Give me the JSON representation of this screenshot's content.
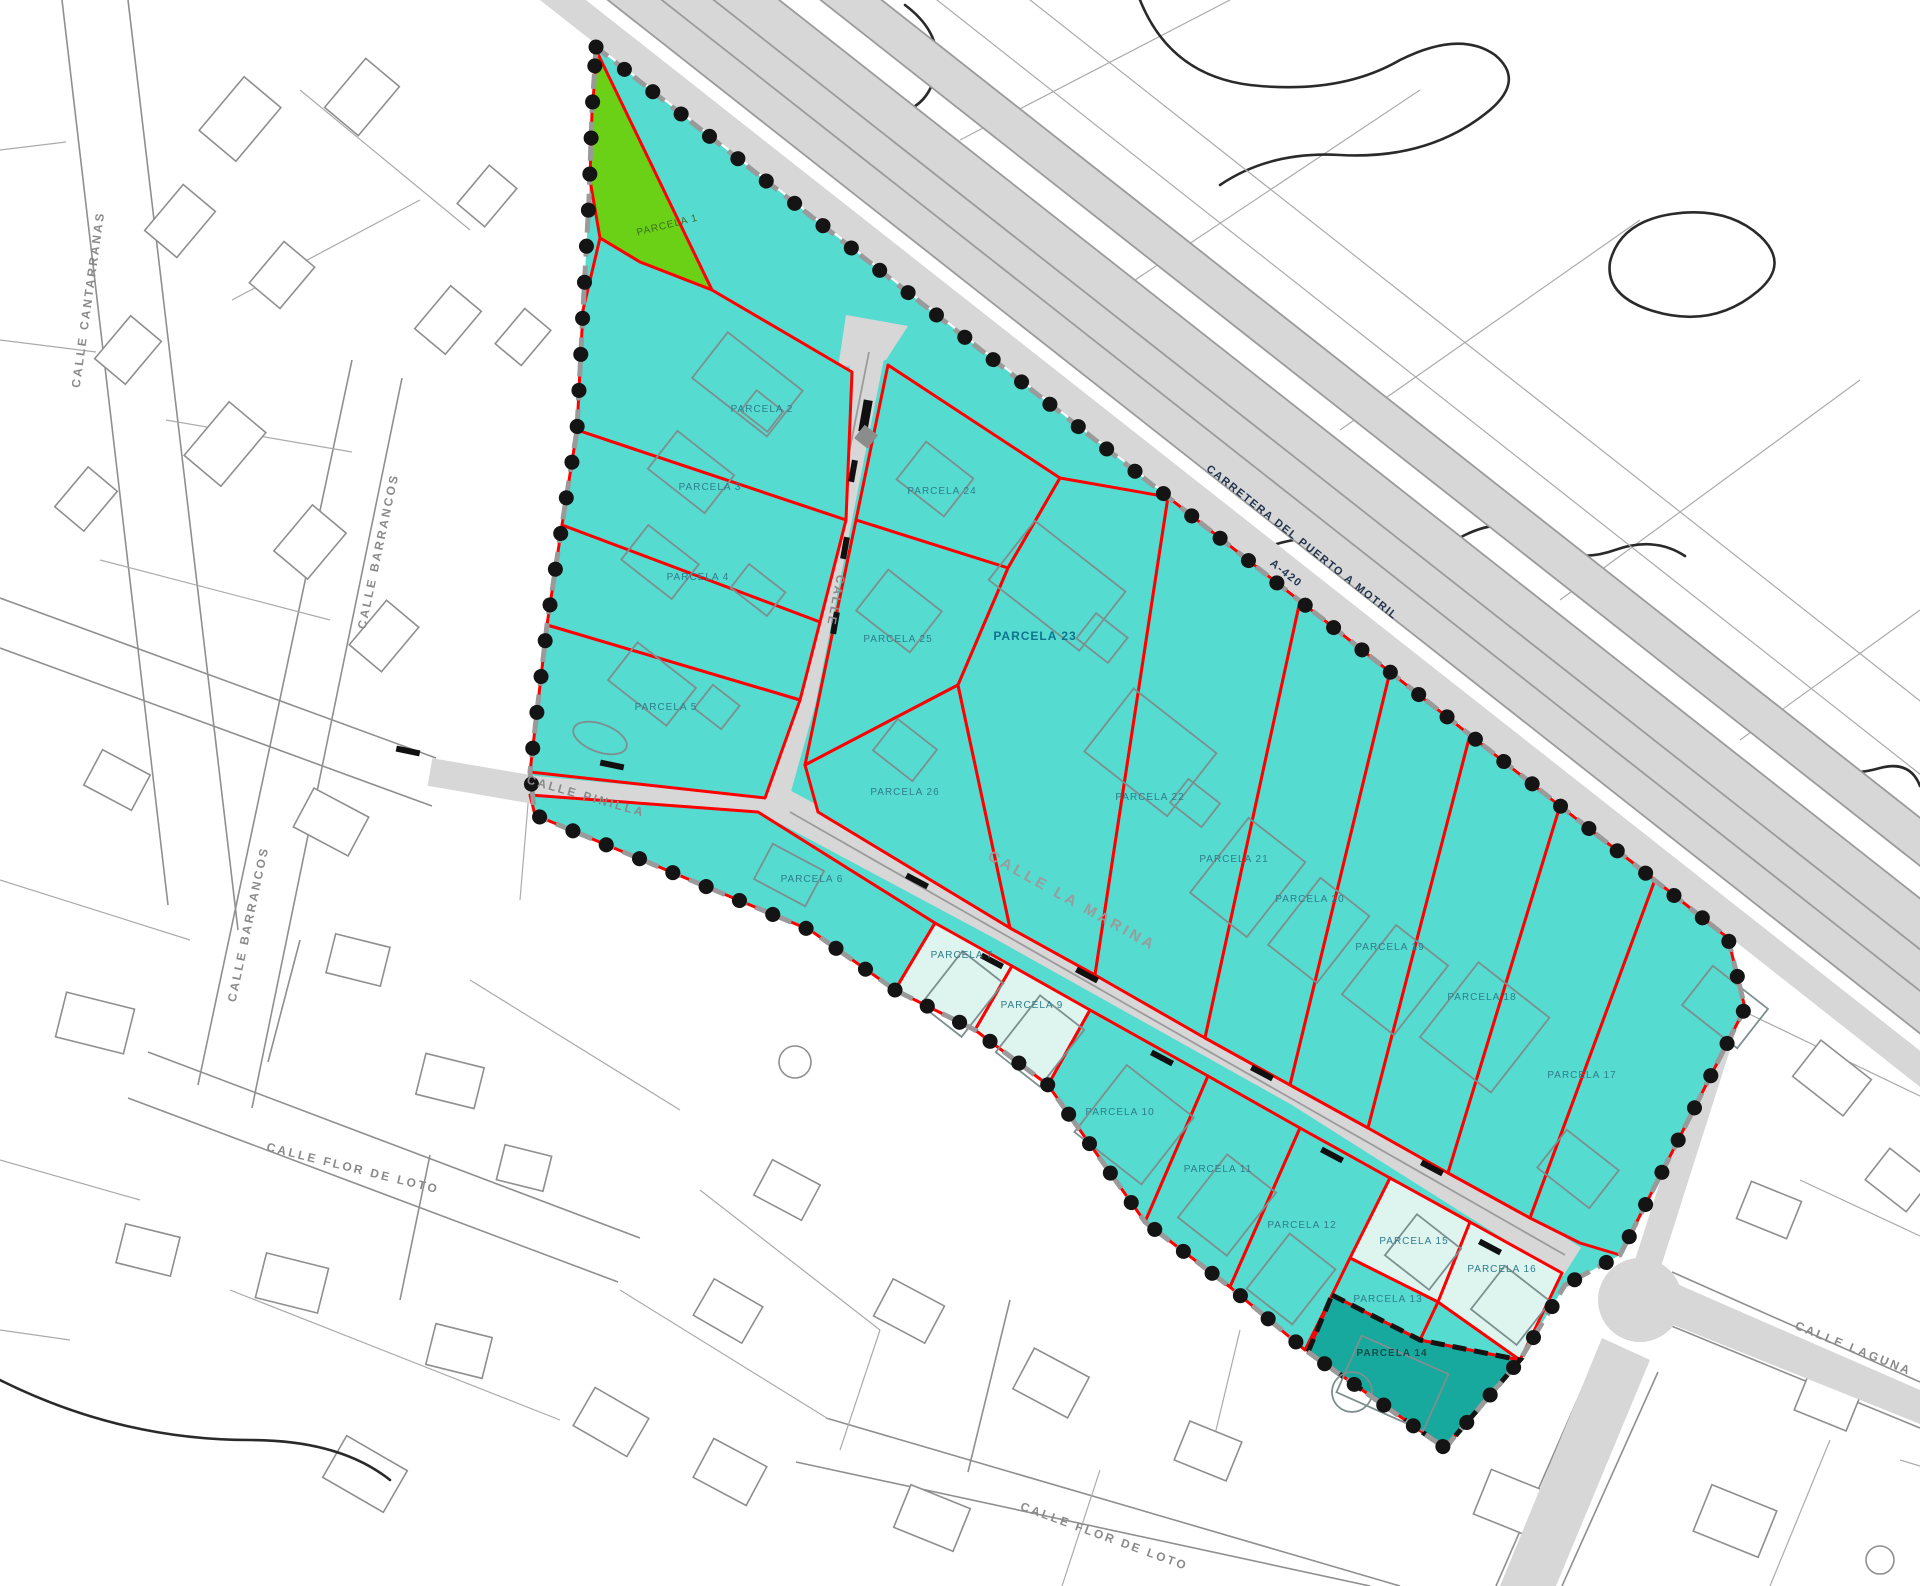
{
  "map": {
    "title": "Plano parcelario de urbanización",
    "highway_label": {
      "line1": "CARRETERA DEL PUERTO A MOTRIL",
      "line2": "A-420"
    },
    "streets": [
      {
        "id": "calle-cantarranas",
        "text": "CALLE CANTARRANAS"
      },
      {
        "id": "calle-barrancos-upper",
        "text": "CALLE BARRANCOS"
      },
      {
        "id": "calle-barrancos-lower",
        "text": "CALLE BARRANCOS"
      },
      {
        "id": "calle-flor-de-loto-west",
        "text": "CALLE FLOR DE LOTO"
      },
      {
        "id": "calle-flor-de-loto-south",
        "text": "CALLE FLOR DE LOTO"
      },
      {
        "id": "calle-laguna",
        "text": "CALLE LAGUNA"
      },
      {
        "id": "calle-pinilla",
        "text": "CALLE PINILLA"
      },
      {
        "id": "calle-la-marina",
        "text": "CALLE LA MARINA"
      },
      {
        "id": "calle-interior",
        "text": "CALLE"
      }
    ],
    "parcels": [
      {
        "id": "parcela-1",
        "label": "PARCELA 1",
        "type": "green"
      },
      {
        "id": "parcela-2",
        "label": "PARCELA 2",
        "type": "standard"
      },
      {
        "id": "parcela-3",
        "label": "PARCELA 3",
        "type": "standard"
      },
      {
        "id": "parcela-4",
        "label": "PARCELA 4",
        "type": "standard"
      },
      {
        "id": "parcela-5",
        "label": "PARCELA 5",
        "type": "standard"
      },
      {
        "id": "parcela-6",
        "label": "PARCELA 6",
        "type": "standard"
      },
      {
        "id": "parcela-7",
        "label": "PARCELA 7",
        "type": "pale"
      },
      {
        "id": "parcela-9",
        "label": "PARCELA 9",
        "type": "pale"
      },
      {
        "id": "parcela-10",
        "label": "PARCELA 10",
        "type": "standard"
      },
      {
        "id": "parcela-11",
        "label": "PARCELA 11",
        "type": "standard"
      },
      {
        "id": "parcela-12",
        "label": "PARCELA 12",
        "type": "standard"
      },
      {
        "id": "parcela-13",
        "label": "PARCELA 13",
        "type": "standard"
      },
      {
        "id": "parcela-14",
        "label": "PARCELA 14",
        "type": "dark"
      },
      {
        "id": "parcela-15",
        "label": "PARCELA 15",
        "type": "pale"
      },
      {
        "id": "parcela-16",
        "label": "PARCELA 16",
        "type": "pale"
      },
      {
        "id": "parcela-17",
        "label": "PARCELA 17",
        "type": "standard"
      },
      {
        "id": "parcela-18",
        "label": "PARCELA 18",
        "type": "standard"
      },
      {
        "id": "parcela-19",
        "label": "PARCELA 19",
        "type": "standard"
      },
      {
        "id": "parcela-20",
        "label": "PARCELA 20",
        "type": "standard"
      },
      {
        "id": "parcela-21",
        "label": "PARCELA 21",
        "type": "standard"
      },
      {
        "id": "parcela-22",
        "label": "PARCELA 22",
        "type": "standard"
      },
      {
        "id": "parcela-23",
        "label": "PARCELA 23",
        "type": "strong"
      },
      {
        "id": "parcela-24",
        "label": "PARCELA 24",
        "type": "standard"
      },
      {
        "id": "parcela-25",
        "label": "PARCELA 25",
        "type": "standard"
      },
      {
        "id": "parcela-26",
        "label": "PARCELA 26",
        "type": "standard"
      }
    ],
    "colors": {
      "parcel_teal": "#55DBCF",
      "parcel_pale": "#DDF4EF",
      "parcel_dark": "#17A99E",
      "parcel_green": "#6BD117",
      "boundary_red": "#FF0000",
      "road_fill": "#D7D7D7",
      "dot_black": "#141414",
      "label_teal": "#2E7D8C"
    }
  }
}
